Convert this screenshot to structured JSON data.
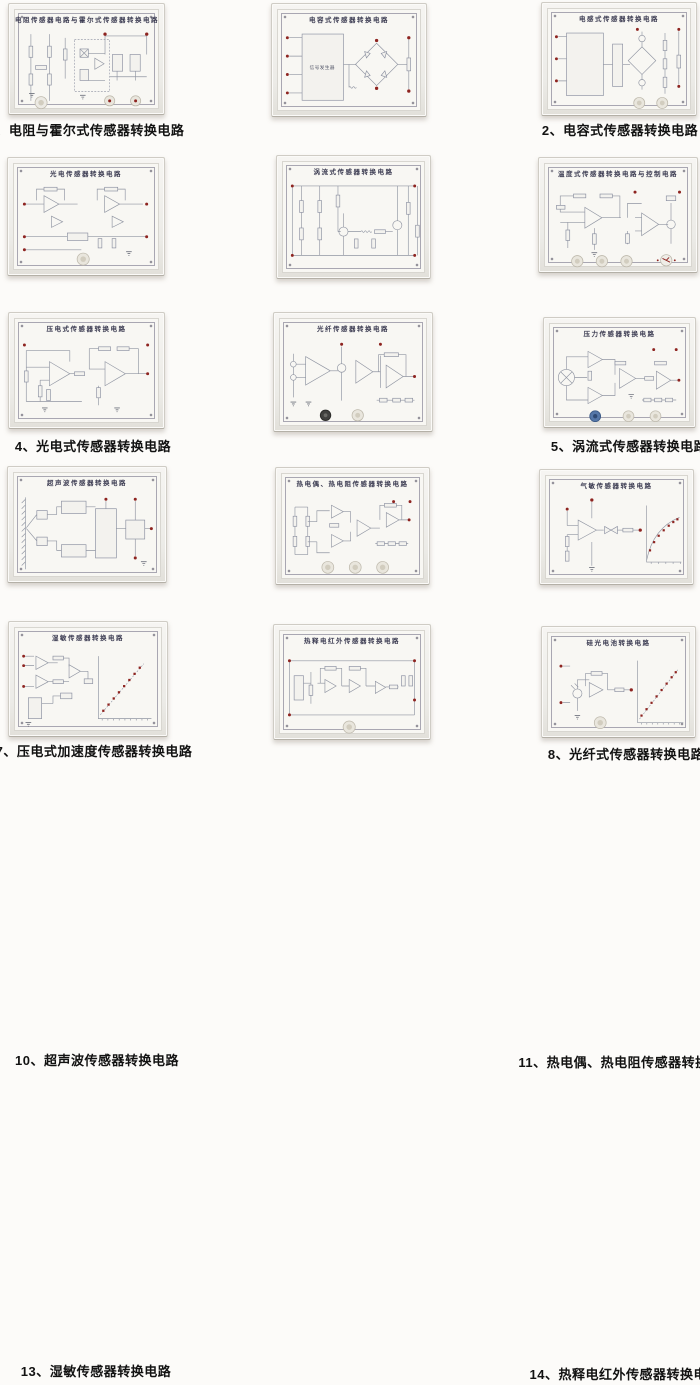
{
  "catalog": {
    "items": [
      {
        "caption": "1、电阻与霍尔式传感器转换电路",
        "board_title": "电阻传感器电路与霍尔式传感器转换电路"
      },
      {
        "caption": "2、电容式传感器转换电路",
        "board_title": "电容式传感器转换电路",
        "block_label": "信号发生器"
      },
      {
        "caption": "3、电感式传感器转换电路",
        "board_title": "电感式传感器转换电路"
      },
      {
        "caption": "4、光电式传感器转换电路",
        "board_title": "光电传感器转换电路"
      },
      {
        "caption": "5、涡流式传感器转换电路",
        "board_title": "涡流式传感器转换电路"
      },
      {
        "caption": "6、温度式传感器转换电路",
        "board_title": "温度式传感器转换电路与控制电路"
      },
      {
        "caption": "7、压电式加速度传感器转换电路",
        "board_title": "压电式传感器转换电路"
      },
      {
        "caption": "8、光纤式传感器转换电路",
        "board_title": "光纤传感器转换电路"
      },
      {
        "caption": "9、压力传感器转换电路",
        "board_title": "压力传感器转换电路"
      },
      {
        "caption": "10、超声波传感器转换电路",
        "board_title": "超声波传感器转换电路"
      },
      {
        "caption": "11、热电偶、热电阻传感器转换电路",
        "board_title": "热电偶、热电阻传感器转换电路"
      },
      {
        "caption": "12、气敏传感器转换电路",
        "board_title": "气敏传感器转换电路"
      },
      {
        "caption": "13、湿敏传感器转换电路",
        "board_title": "湿敏传感器转换电路"
      },
      {
        "caption": "14、热释电红外传感器转换电路",
        "board_title": "热释电红外传感器转换电路"
      },
      {
        "caption": "15、硅光电池转换电路",
        "board_title": "硅光电池转换电路"
      }
    ],
    "colors": {
      "background": "#fcfbf9",
      "panel_face": "#f8f7f3",
      "frame": "#ecebe7",
      "circuit_line": "#9095a2",
      "terminal_red": "#8e2420",
      "caption_text": "#121212"
    }
  }
}
